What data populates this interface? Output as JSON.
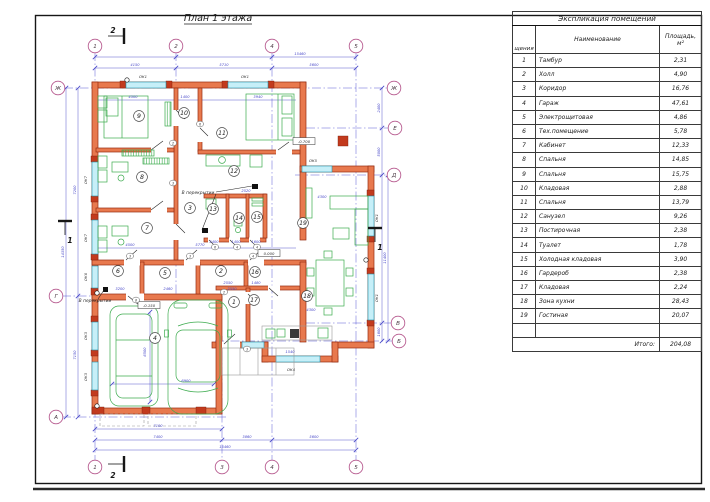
{
  "colors": {
    "wall_fill": "#e8794e",
    "wall_stroke": "#962d12",
    "window_fill": "#c6eff8",
    "furniture_green": "#3cab4e",
    "dimension_blue": "#4646c8",
    "axis_bubble_pink": "#b5568c"
  },
  "plan": {
    "title": "План 1 этажа",
    "sec1": "1",
    "sec2": "2",
    "bubbles": [
      {
        "x": 95,
        "y": 46,
        "t": "1"
      },
      {
        "x": 176,
        "y": 46,
        "t": "2"
      },
      {
        "x": 272,
        "y": 46,
        "t": "4"
      },
      {
        "x": 356,
        "y": 46,
        "t": "5"
      },
      {
        "x": 95,
        "y": 467,
        "t": "1"
      },
      {
        "x": 222,
        "y": 467,
        "t": "3"
      },
      {
        "x": 272,
        "y": 467,
        "t": "4"
      },
      {
        "x": 356,
        "y": 467,
        "t": "5"
      },
      {
        "x": 58,
        "y": 88,
        "t": "Ж"
      },
      {
        "x": 56,
        "y": 296,
        "t": "Г"
      },
      {
        "x": 56,
        "y": 417,
        "t": "А"
      },
      {
        "x": 394,
        "y": 88,
        "t": "Ж"
      },
      {
        "x": 395,
        "y": 128,
        "t": "Е"
      },
      {
        "x": 394,
        "y": 175,
        "t": "Д"
      },
      {
        "x": 398,
        "y": 323,
        "t": "В"
      },
      {
        "x": 399,
        "y": 341,
        "t": "Б"
      }
    ],
    "dims": [
      {
        "x": 300,
        "y": 55,
        "t": "15460"
      },
      {
        "x": 135,
        "y": 66,
        "t": "4150"
      },
      {
        "x": 224,
        "y": 66,
        "t": "5710"
      },
      {
        "x": 314,
        "y": 66,
        "t": "5600"
      },
      {
        "x": 158,
        "y": 427,
        "t": "7100"
      },
      {
        "x": 158,
        "y": 438,
        "t": "7400"
      },
      {
        "x": 247,
        "y": 438,
        "t": "3860"
      },
      {
        "x": 314,
        "y": 438,
        "t": "5600"
      },
      {
        "x": 225,
        "y": 448,
        "t": "15460"
      },
      {
        "x": 76,
        "y": 190,
        "t": "7200",
        "r": -90
      },
      {
        "x": 76,
        "y": 355,
        "t": "7150",
        "r": -90
      },
      {
        "x": 64,
        "y": 252,
        "t": "14350",
        "r": -90
      },
      {
        "x": 380,
        "y": 108,
        "t": "2400",
        "r": -90
      },
      {
        "x": 380,
        "y": 152,
        "t": "5000",
        "r": -90
      },
      {
        "x": 386,
        "y": 258,
        "t": "11400",
        "r": -90
      },
      {
        "x": 380,
        "y": 332,
        "t": "1800",
        "r": -90
      },
      {
        "x": 133,
        "y": 98,
        "t": "4500"
      },
      {
        "x": 185,
        "y": 98,
        "t": "1400"
      },
      {
        "x": 258,
        "y": 98,
        "t": "3940"
      },
      {
        "x": 200,
        "y": 246,
        "t": "5770"
      },
      {
        "x": 228,
        "y": 284,
        "t": "2550"
      },
      {
        "x": 256,
        "y": 284,
        "t": "1480"
      },
      {
        "x": 186,
        "y": 382,
        "t": "6900"
      },
      {
        "x": 146,
        "y": 352,
        "t": "6500",
        "r": -90
      },
      {
        "x": 311,
        "y": 311,
        "t": "4300"
      },
      {
        "x": 322,
        "y": 198,
        "t": "4300"
      },
      {
        "x": 130,
        "y": 246,
        "t": "4500"
      },
      {
        "x": 246,
        "y": 192,
        "t": "2520"
      },
      {
        "x": 214,
        "y": 243,
        "t": "2400"
      },
      {
        "x": 236,
        "y": 243,
        "t": "1400"
      },
      {
        "x": 256,
        "y": 243,
        "t": "1600"
      },
      {
        "x": 120,
        "y": 290,
        "t": "3200"
      },
      {
        "x": 168,
        "y": 290,
        "t": "2460"
      },
      {
        "x": 232,
        "y": 290,
        "t": "2550"
      },
      {
        "x": 290,
        "y": 353,
        "t": "1540"
      }
    ],
    "rooms": [
      {
        "x": 139,
        "y": 116,
        "t": "9"
      },
      {
        "x": 184,
        "y": 113,
        "t": "10"
      },
      {
        "x": 222,
        "y": 133,
        "t": "11"
      },
      {
        "x": 142,
        "y": 177,
        "t": "8"
      },
      {
        "x": 234,
        "y": 171,
        "t": "12"
      },
      {
        "x": 190,
        "y": 208,
        "t": "3"
      },
      {
        "x": 147,
        "y": 228,
        "t": "7"
      },
      {
        "x": 213,
        "y": 209,
        "t": "13"
      },
      {
        "x": 239,
        "y": 218,
        "t": "14"
      },
      {
        "x": 257,
        "y": 217,
        "t": "15"
      },
      {
        "x": 303,
        "y": 223,
        "t": "19"
      },
      {
        "x": 118,
        "y": 271,
        "t": "6"
      },
      {
        "x": 165,
        "y": 273,
        "t": "5"
      },
      {
        "x": 221,
        "y": 271,
        "t": "2"
      },
      {
        "x": 255,
        "y": 272,
        "t": "16"
      },
      {
        "x": 234,
        "y": 302,
        "t": "1"
      },
      {
        "x": 254,
        "y": 300,
        "t": "17"
      },
      {
        "x": 307,
        "y": 296,
        "t": "18"
      },
      {
        "x": 155,
        "y": 338,
        "t": "4"
      }
    ],
    "window_labels": [
      {
        "x": 143,
        "y": 78,
        "t": "ОК1"
      },
      {
        "x": 245,
        "y": 78,
        "t": "ОК1"
      },
      {
        "x": 87,
        "y": 180,
        "t": "ОК7",
        "r": -90
      },
      {
        "x": 87,
        "y": 238,
        "t": "ОК7",
        "r": -90
      },
      {
        "x": 87,
        "y": 277,
        "t": "ОК6",
        "r": -90
      },
      {
        "x": 87,
        "y": 336,
        "t": "ОК3",
        "r": -90
      },
      {
        "x": 87,
        "y": 377,
        "t": "ОК3",
        "r": -90
      },
      {
        "x": 313,
        "y": 162,
        "t": "ОК5"
      },
      {
        "x": 291,
        "y": 371,
        "t": "ОК4"
      },
      {
        "x": 378,
        "y": 218,
        "t": "ОК1",
        "r": -90
      },
      {
        "x": 378,
        "y": 298,
        "t": "ОК1",
        "r": -90
      }
    ],
    "door_tags": [
      {
        "x": 200,
        "y": 124,
        "t": "6"
      },
      {
        "x": 173,
        "y": 143,
        "t": "2"
      },
      {
        "x": 173,
        "y": 183,
        "t": "3"
      },
      {
        "x": 130,
        "y": 256,
        "t": "3"
      },
      {
        "x": 190,
        "y": 256,
        "t": "3"
      },
      {
        "x": 253,
        "y": 256,
        "t": "4"
      },
      {
        "x": 215,
        "y": 247,
        "t": "6"
      },
      {
        "x": 237,
        "y": 247,
        "t": "4"
      },
      {
        "x": 257,
        "y": 247,
        "t": "4"
      },
      {
        "x": 136,
        "y": 300,
        "t": "8"
      },
      {
        "x": 224,
        "y": 292,
        "t": "2"
      },
      {
        "x": 247,
        "y": 349,
        "t": "3"
      }
    ],
    "notes": [
      {
        "x": 198,
        "y": 194,
        "t": "В перекрытии"
      },
      {
        "x": 95,
        "y": 302,
        "t": "В перекрытии"
      }
    ],
    "elevations": [
      {
        "x": 269,
        "y": 255,
        "t": "0.000"
      },
      {
        "x": 149,
        "y": 307,
        "t": "-0.150"
      },
      {
        "x": 304,
        "y": 143,
        "t": "-0.700"
      }
    ]
  },
  "table": {
    "title": "Экспликация помещений",
    "col_num": "щения",
    "col_name": "Наименование",
    "col_area1": "Площадь,",
    "col_area2": "м²",
    "rows": [
      {
        "num": "1",
        "name": "Тамбур",
        "area": "2,31"
      },
      {
        "num": "2",
        "name": "Холл",
        "area": "4,90"
      },
      {
        "num": "3",
        "name": "Коридор",
        "area": "16,76"
      },
      {
        "num": "4",
        "name": "Гараж",
        "area": "47,61"
      },
      {
        "num": "5",
        "name": "Электрощитовая",
        "area": "4,86"
      },
      {
        "num": "6",
        "name": "Тех.помещение",
        "area": "5,78"
      },
      {
        "num": "7",
        "name": "Кабинет",
        "area": "12,33"
      },
      {
        "num": "8",
        "name": "Спальня",
        "area": "14,85"
      },
      {
        "num": "9",
        "name": "Спальня",
        "area": "15,75"
      },
      {
        "num": "10",
        "name": "Кладовая",
        "area": "2,88"
      },
      {
        "num": "11",
        "name": "Спальня",
        "area": "13,79"
      },
      {
        "num": "12",
        "name": "Санузел",
        "area": "9,26"
      },
      {
        "num": "13",
        "name": "Постирочная",
        "area": "2,38"
      },
      {
        "num": "14",
        "name": "Туалет",
        "area": "1,78"
      },
      {
        "num": "15",
        "name": "Холодная кладовая",
        "area": "3,90"
      },
      {
        "num": "16",
        "name": "Гардероб",
        "area": "2,38"
      },
      {
        "num": "17",
        "name": "Кладовая",
        "area": "2,24"
      },
      {
        "num": "18",
        "name": "Зона кухни",
        "area": "28,43"
      },
      {
        "num": "19",
        "name": "Гостиная",
        "area": "20,07"
      }
    ],
    "total_label": "Итого:",
    "total_value": "204,08"
  }
}
